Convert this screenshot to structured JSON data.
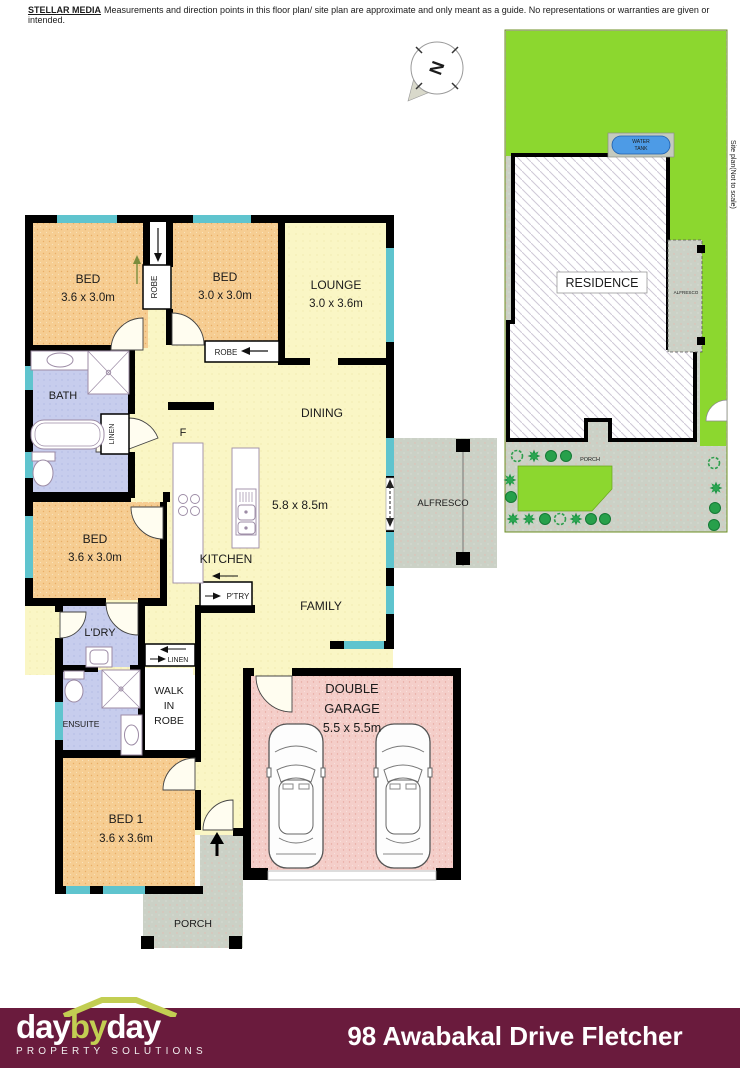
{
  "disclaimer": {
    "brand": "STELLAR MEDIA",
    "text": "Measurements and direction points in this floor plan/ site plan are approximate and only meant as a guide. No representations or warranties are given or intended."
  },
  "compass": {
    "n": "N"
  },
  "fp": {
    "bed_tl_name": "BED",
    "bed_tl_dims": "3.6 x 3.0m",
    "bed_tm_name": "BED",
    "bed_tm_dims": "3.0 x 3.0m",
    "lounge_name": "LOUNGE",
    "lounge_dims": "3.0 x 3.6m",
    "robe1": "ROBE",
    "robe2": "ROBE",
    "bath": "BATH",
    "linen1": "LINEN",
    "dining": "DINING",
    "fridge": "F",
    "living_dims": "5.8 x 8.5m",
    "kitchen": "KITCHEN",
    "pantry": "P'TRY",
    "family": "FAMILY",
    "alfresco": "ALFRESCO",
    "bed3_name": "BED",
    "bed3_dims": "3.6 x 3.0m",
    "laundry": "L'DRY",
    "linen2": "LINEN",
    "wir1": "WALK",
    "wir2": "IN",
    "wir3": "ROBE",
    "ensuite": "ENSUITE",
    "bed1_name": "BED 1",
    "bed1_dims": "3.6 x 3.6m",
    "garage1": "DOUBLE",
    "garage2": "GARAGE",
    "garage_dims": "5.5 x 5.5m",
    "porch": "PORCH"
  },
  "site": {
    "residence": "RESIDENCE",
    "tank1": "WATER",
    "tank2": "TANK",
    "alfresco": "ALFRESCO",
    "porch": "PORCH",
    "caption": "Site plan(Not to scale)"
  },
  "footer": {
    "logo_day1": "day",
    "logo_by": "by",
    "logo_day2": "day",
    "tagline": "PROPERTY SOLUTIONS",
    "address": "98 Awabakal Drive Fletcher"
  },
  "colors": {
    "bedroom": "#F6CD92",
    "living": "#FAF6C5",
    "wet_area": "#C7CDED",
    "garage": "#F4CEC9",
    "outdoor_gray": "#CBD1C6",
    "window": "#5FC4CE",
    "lawn": "#8CD72F",
    "plant": "#27A04B",
    "footer_bg": "#6A1B3D",
    "logo_accent": "#C2CE52",
    "water_tank": "#4D9BE6"
  }
}
